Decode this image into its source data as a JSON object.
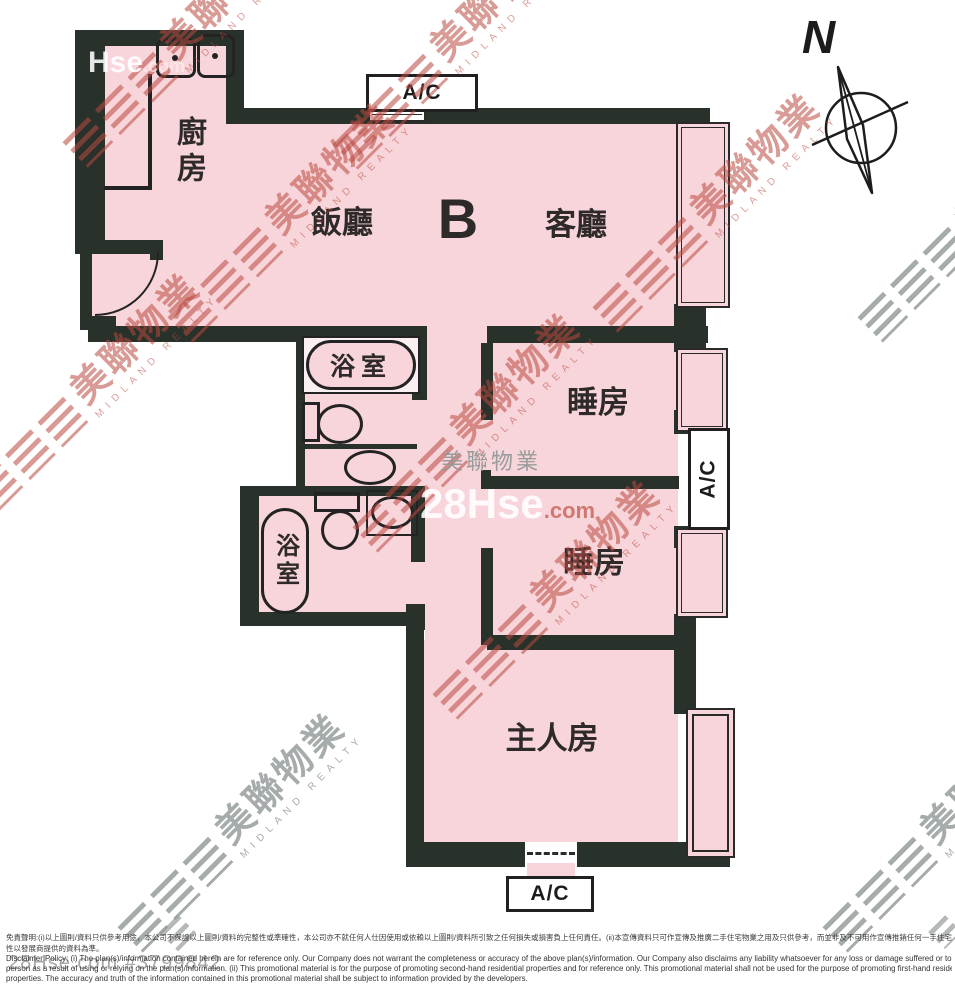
{
  "plan": {
    "unit_label": "B",
    "compass_north": "N",
    "ac_label": "A/C",
    "rooms": {
      "kitchen": "廚房",
      "dining": "飯廳",
      "living": "客廳",
      "bathroom": "浴室",
      "bedroom": "睡房",
      "master_bedroom": "主人房"
    }
  },
  "watermarks": {
    "midland_cn": "美聯物業",
    "midland_en": "MIDLAND REALTY",
    "midland_gray_cn": "美聯物業",
    "hse_main": "28Hse",
    "hse_dot_com": ".com",
    "hse_partial": "Hse",
    "hse_partial_dot": ".com",
    "listing_ref": "28Hse.com  #3799842"
  },
  "disclaimer": {
    "zh_line1": "免責聲明:(i)以上圖則/資料只供參考用途，本公司不保證以上圖則/資料的完整性或準確性，本公司亦不就任何人仕因使用或依賴以上圖則/資料所引致之任何損失或損害負上任何責任。(ii)本宣傳資料只可作宣傳及推廣二手住宅物業之用及只供參考，而並非及不可用作宣傳推銷任何一手住宅物業，其準確性及真實",
    "zh_line2": "性以發展商提供的資料為準。",
    "en_line1": "Disclaimer Policy: (i) The plan(s)/information contained herein are for reference only. Our Company does not warrant the completeness or accuracy of the above plan(s)/information. Our Company also disclaims any liability whatsoever for any loss or damage suffered or to be suffered by any",
    "en_line2": "person as a result of using or relying on the plan(s)/information. (ii) This promotional material is for the purpose of promoting second-hand residential properties and for reference only. This promotional material shall not be used for the purpose of promoting first-hand residential",
    "en_line3": "properties. The accuracy and truth of the information contained in this promotional material shall be subject to information provided by the developers."
  },
  "colors": {
    "floor": "#f8d5da",
    "wall": "#28322b",
    "watermark_red": "#ba4840",
    "watermark_gray": "#8d9393",
    "background": "#ffffff"
  }
}
